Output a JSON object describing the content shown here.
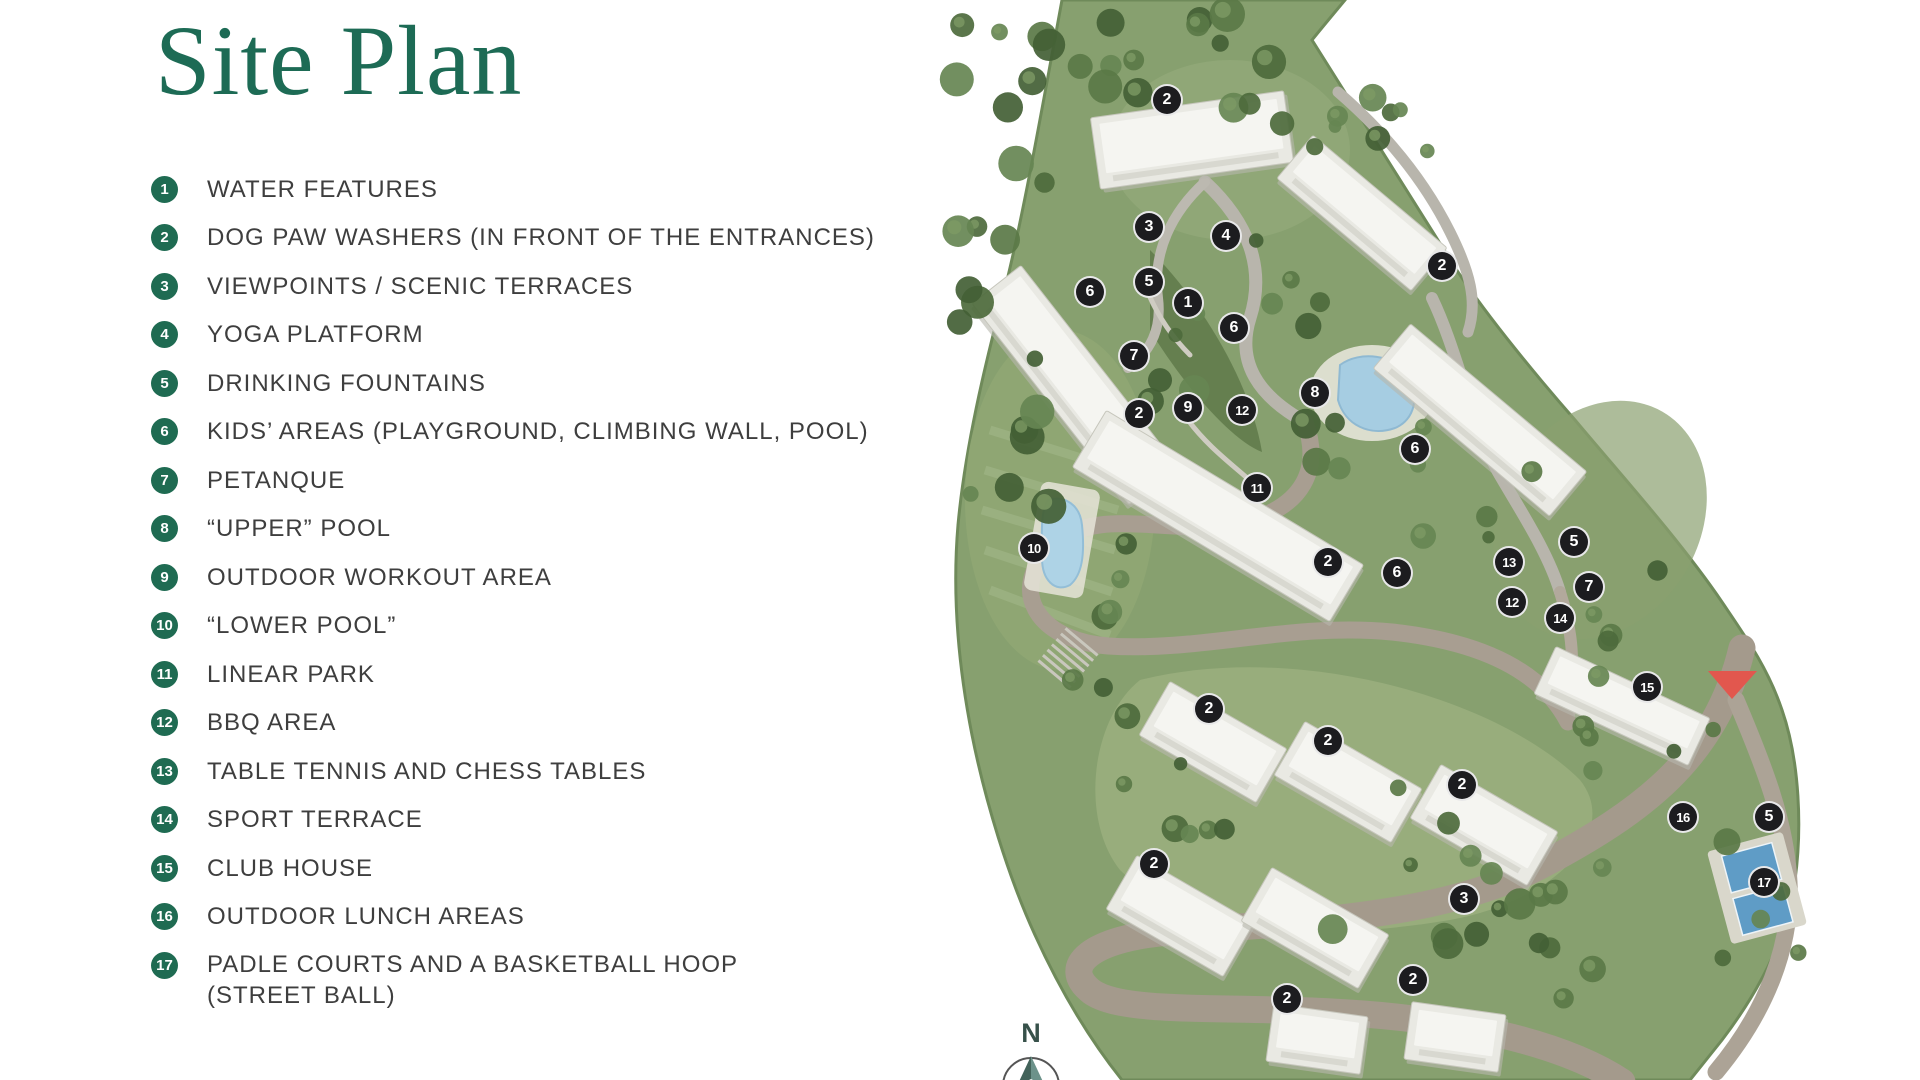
{
  "title": "Site Plan",
  "legend": {
    "items": [
      {
        "num": "1",
        "label": "WATER FEATURES"
      },
      {
        "num": "2",
        "label": "DOG PAW WASHERS (IN FRONT OF THE ENTRANCES)"
      },
      {
        "num": "3",
        "label": "VIEWPOINTS / SCENIC TERRACES"
      },
      {
        "num": "4",
        "label": "YOGA PLATFORM"
      },
      {
        "num": "5",
        "label": "DRINKING FOUNTAINS"
      },
      {
        "num": "6",
        "label": "KIDS’ AREAS (PLAYGROUND, CLIMBING WALL, POOL)"
      },
      {
        "num": "7",
        "label": "PETANQUE"
      },
      {
        "num": "8",
        "label": "“UPPER” POOL"
      },
      {
        "num": "9",
        "label": "OUTDOOR WORKOUT AREA"
      },
      {
        "num": "10",
        "label": "“LOWER POOL”"
      },
      {
        "num": "11",
        "label": "LINEAR PARK"
      },
      {
        "num": "12",
        "label": "BBQ AREA"
      },
      {
        "num": "13",
        "label": "TABLE TENNIS AND CHESS TABLES"
      },
      {
        "num": "14",
        "label": "SPORT TERRACE"
      },
      {
        "num": "15",
        "label": "CLUB HOUSE"
      },
      {
        "num": "16",
        "label": "OUTDOOR LUNCH AREAS"
      },
      {
        "num": "17",
        "label": "PADLE COURTS AND A BASKETBALL HOOP",
        "label2": "(STREET BALL)"
      }
    ]
  },
  "map": {
    "markers": [
      {
        "num": "2",
        "x": 1167,
        "y": 100
      },
      {
        "num": "3",
        "x": 1149,
        "y": 227
      },
      {
        "num": "4",
        "x": 1226,
        "y": 236
      },
      {
        "num": "2",
        "x": 1442,
        "y": 266
      },
      {
        "num": "5",
        "x": 1149,
        "y": 282
      },
      {
        "num": "6",
        "x": 1090,
        "y": 292
      },
      {
        "num": "1",
        "x": 1188,
        "y": 303
      },
      {
        "num": "6",
        "x": 1234,
        "y": 328
      },
      {
        "num": "7",
        "x": 1134,
        "y": 356
      },
      {
        "num": "8",
        "x": 1315,
        "y": 393
      },
      {
        "num": "9",
        "x": 1188,
        "y": 408
      },
      {
        "num": "12",
        "x": 1242,
        "y": 410
      },
      {
        "num": "2",
        "x": 1139,
        "y": 414
      },
      {
        "num": "6",
        "x": 1415,
        "y": 449
      },
      {
        "num": "11",
        "x": 1257,
        "y": 488
      },
      {
        "num": "10",
        "x": 1034,
        "y": 548
      },
      {
        "num": "5",
        "x": 1574,
        "y": 542
      },
      {
        "num": "13",
        "x": 1509,
        "y": 562
      },
      {
        "num": "2",
        "x": 1328,
        "y": 562
      },
      {
        "num": "6",
        "x": 1397,
        "y": 573
      },
      {
        "num": "7",
        "x": 1589,
        "y": 587
      },
      {
        "num": "12",
        "x": 1512,
        "y": 602
      },
      {
        "num": "14",
        "x": 1560,
        "y": 618
      },
      {
        "num": "15",
        "x": 1647,
        "y": 687
      },
      {
        "num": "2",
        "x": 1209,
        "y": 709
      },
      {
        "num": "2",
        "x": 1328,
        "y": 741
      },
      {
        "num": "2",
        "x": 1462,
        "y": 785
      },
      {
        "num": "16",
        "x": 1683,
        "y": 817
      },
      {
        "num": "5",
        "x": 1769,
        "y": 817
      },
      {
        "num": "2",
        "x": 1154,
        "y": 864
      },
      {
        "num": "17",
        "x": 1764,
        "y": 882
      },
      {
        "num": "3",
        "x": 1464,
        "y": 899
      },
      {
        "num": "2",
        "x": 1413,
        "y": 980
      },
      {
        "num": "2",
        "x": 1287,
        "y": 999
      }
    ],
    "entrance": {
      "x": 1732,
      "y": 684
    },
    "compass": {
      "label": "N",
      "x": 1031,
      "y": 1042
    }
  },
  "colors": {
    "title_green": "#1d6b55",
    "badge_green": "#1f6b52",
    "marker_black": "#1c1c1f",
    "entrance_red": "#e2574e",
    "pool_blue": "#a6cde2"
  }
}
